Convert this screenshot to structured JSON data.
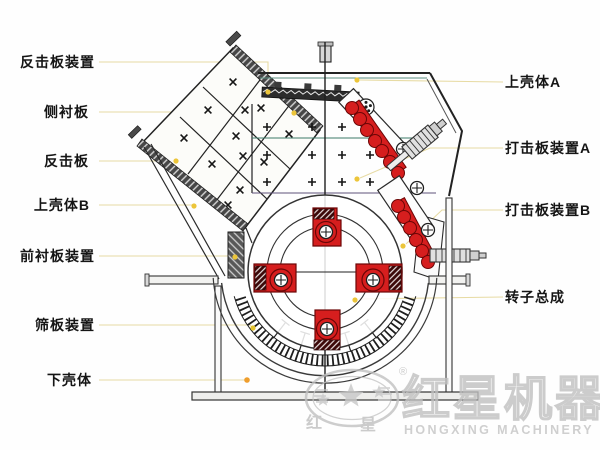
{
  "labels": {
    "left": [
      {
        "text": "反击板装置"
      },
      {
        "text": "侧衬板"
      },
      {
        "text": "反击板"
      },
      {
        "text": "上壳体B"
      },
      {
        "text": "前衬板装置"
      },
      {
        "text": "筛板装置"
      },
      {
        "text": "下壳体"
      }
    ],
    "right": [
      {
        "text": "上壳体A"
      },
      {
        "text": "打击板装置A"
      },
      {
        "text": "打击板装置B"
      },
      {
        "text": "转子总成"
      }
    ]
  },
  "watermark": {
    "brand_cn": "红星机器",
    "brand_en": "HONGXING MACHINERY",
    "registered": "®",
    "seal_left": "红",
    "seal_right": "星"
  }
}
